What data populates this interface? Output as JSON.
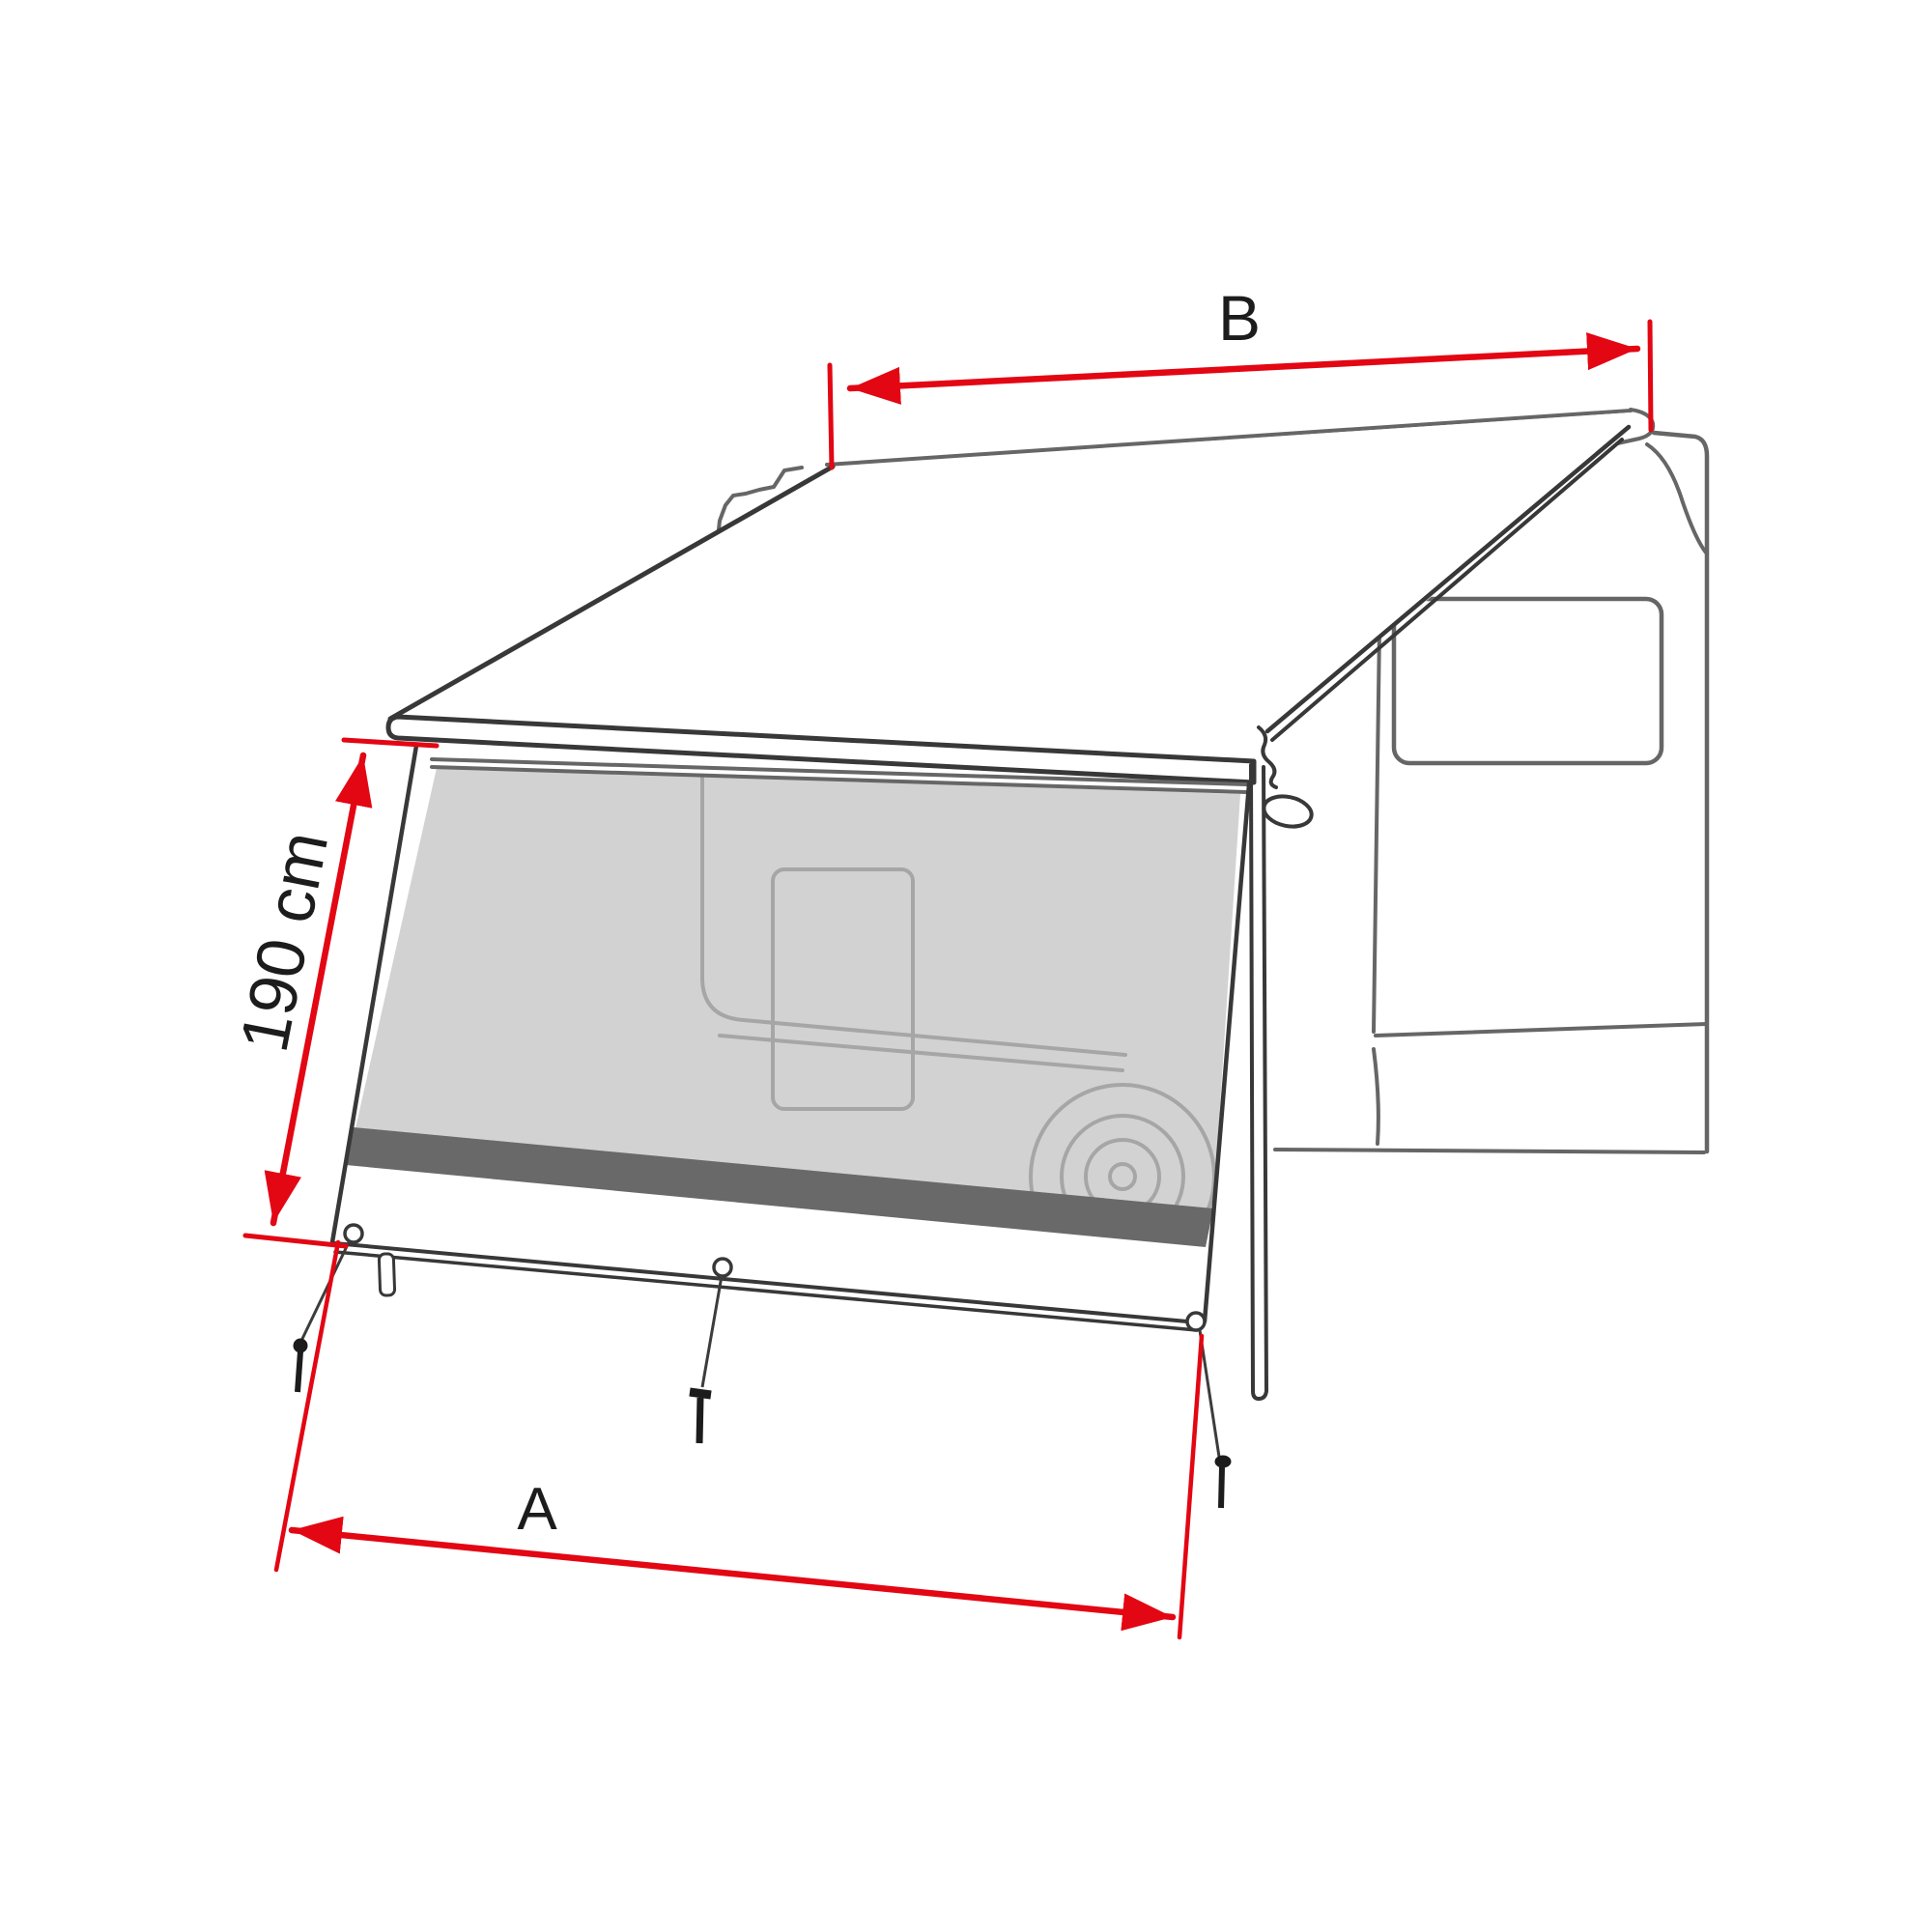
{
  "diagram_title": "Awning sun-view front panel dimension drawing",
  "dimensions": {
    "top_width": {
      "label": "B"
    },
    "side_height": {
      "label": "190 cm"
    },
    "bottom_width": {
      "label": "A"
    }
  },
  "colors": {
    "dimension_red": "#e30613",
    "line_dark": "#383838",
    "line_medium": "#666666",
    "line_light": "#a6a6a6",
    "mesh_fill": "#d2d2d2",
    "stripe_fill": "#696969",
    "background": "#ffffff"
  }
}
